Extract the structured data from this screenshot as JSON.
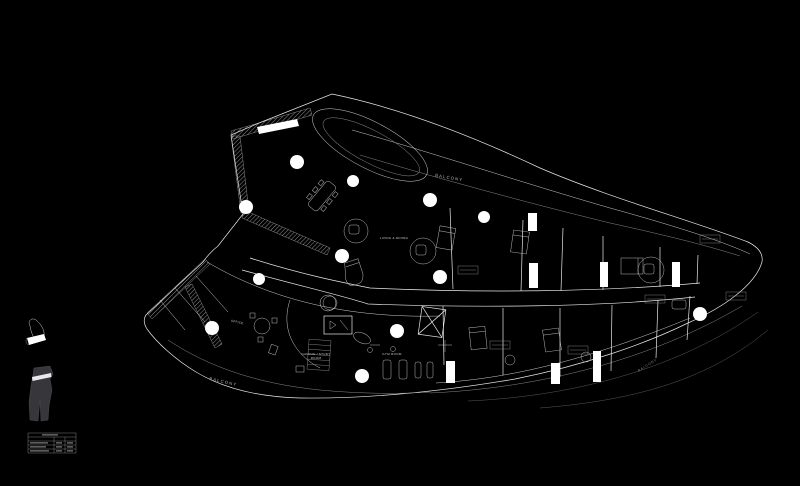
{
  "labels": {
    "balcony_top": "BALCONY",
    "balcony_bottom_left": "BALCONY",
    "balcony_right": "BALCONY",
    "living_dining": "LIVING & DINING",
    "office": "OFFICE",
    "gaming_study_line1": "GAMING / STUDY",
    "gaming_study_line2": "ROOM",
    "gym_room": "GYM ROOM"
  },
  "colors": {
    "background": "#000000",
    "linework": "#ffffff",
    "dim_linework": "#8a8a8a",
    "column_fill": "#ffffff",
    "keyplan_fill": "#37373b",
    "label_text": "#c8c8c8"
  }
}
